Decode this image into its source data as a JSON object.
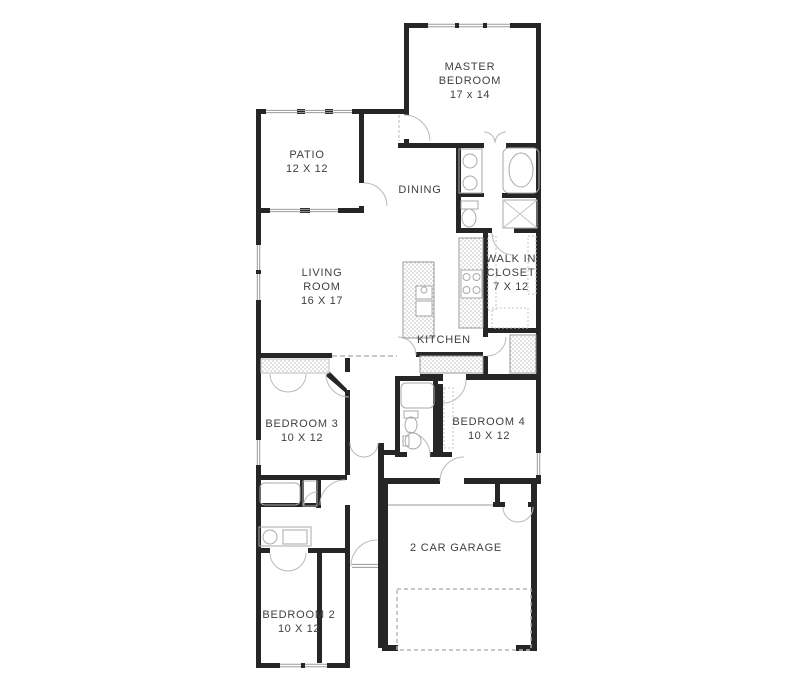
{
  "plan_title": "single-story house floor plan",
  "colors": {
    "wall": "#262626",
    "thin_line": "#9a9a9a",
    "fixture_line": "#a9a9a9",
    "hatch": "#bdbdbd",
    "dash": "#b5b5b5",
    "text": "#3f3f3f",
    "background": "#ffffff"
  },
  "rooms": [
    {
      "id": "master-bedroom",
      "name": "MASTER BEDROOM",
      "dims": "17 x 14"
    },
    {
      "id": "patio",
      "name": "PATIO",
      "dims": "12 X 12"
    },
    {
      "id": "dining",
      "name": "DINING",
      "dims": ""
    },
    {
      "id": "living-room",
      "name": "LIVING ROOM",
      "dims": "16 X 17"
    },
    {
      "id": "walk-in-closet",
      "name": "WALK IN CLOSET",
      "dims": "7 X 12"
    },
    {
      "id": "kitchen",
      "name": "KITCHEN",
      "dims": ""
    },
    {
      "id": "bedroom-3",
      "name": "BEDROOM 3",
      "dims": "10 X 12"
    },
    {
      "id": "bedroom-4",
      "name": "BEDROOM 4",
      "dims": "10 X 12"
    },
    {
      "id": "bedroom-2",
      "name": "BEDROOM 2",
      "dims": "10 X 12"
    },
    {
      "id": "garage",
      "name": "2 CAR GARAGE",
      "dims": ""
    }
  ]
}
